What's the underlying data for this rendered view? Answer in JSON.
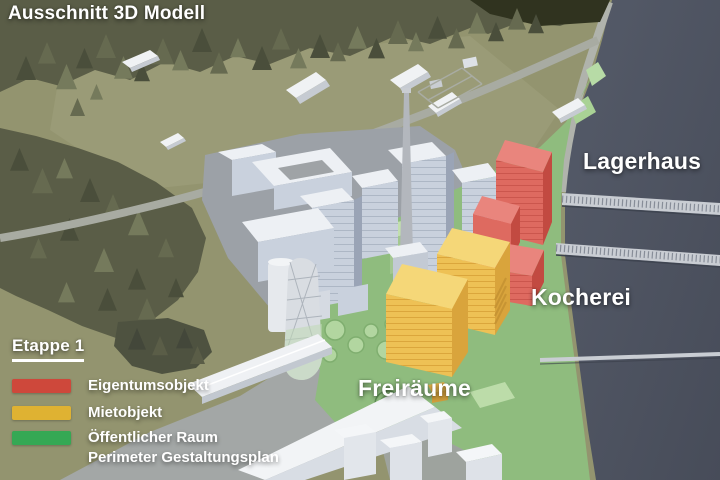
{
  "title": "Ausschnitt 3D Modell",
  "map_labels": {
    "lagerhaus": "Lagerhaus",
    "kocherei": "Kocherei",
    "freiraeume": "Freiräume"
  },
  "legend": {
    "heading": "Etappe 1",
    "items": [
      {
        "id": "eigentumsobjekt",
        "label": "Eigentumsobjekt",
        "color": "#CE483B"
      },
      {
        "id": "mietobjekt",
        "label": "Mietobjekt",
        "color": "#DFB232"
      },
      {
        "id": "oeffentlicher-raum",
        "lines": [
          "Öffentlicher Raum",
          "Perimeter Gestaltungsplan"
        ],
        "color": "#35A854"
      }
    ]
  },
  "scene": {
    "description": "3D model excerpt: white town model, red Lagerhaus buildings, yellow Kocherei buildings, green public space along dark river with bridges",
    "colors": {
      "terrain": "#93946F",
      "forest": "#5A5D47",
      "river": "#4C5160",
      "public_green": "#8FBC7E",
      "building_red": "#DE6A60",
      "building_yellow": "#EEC155",
      "building_white": "#EDF0F4"
    }
  }
}
